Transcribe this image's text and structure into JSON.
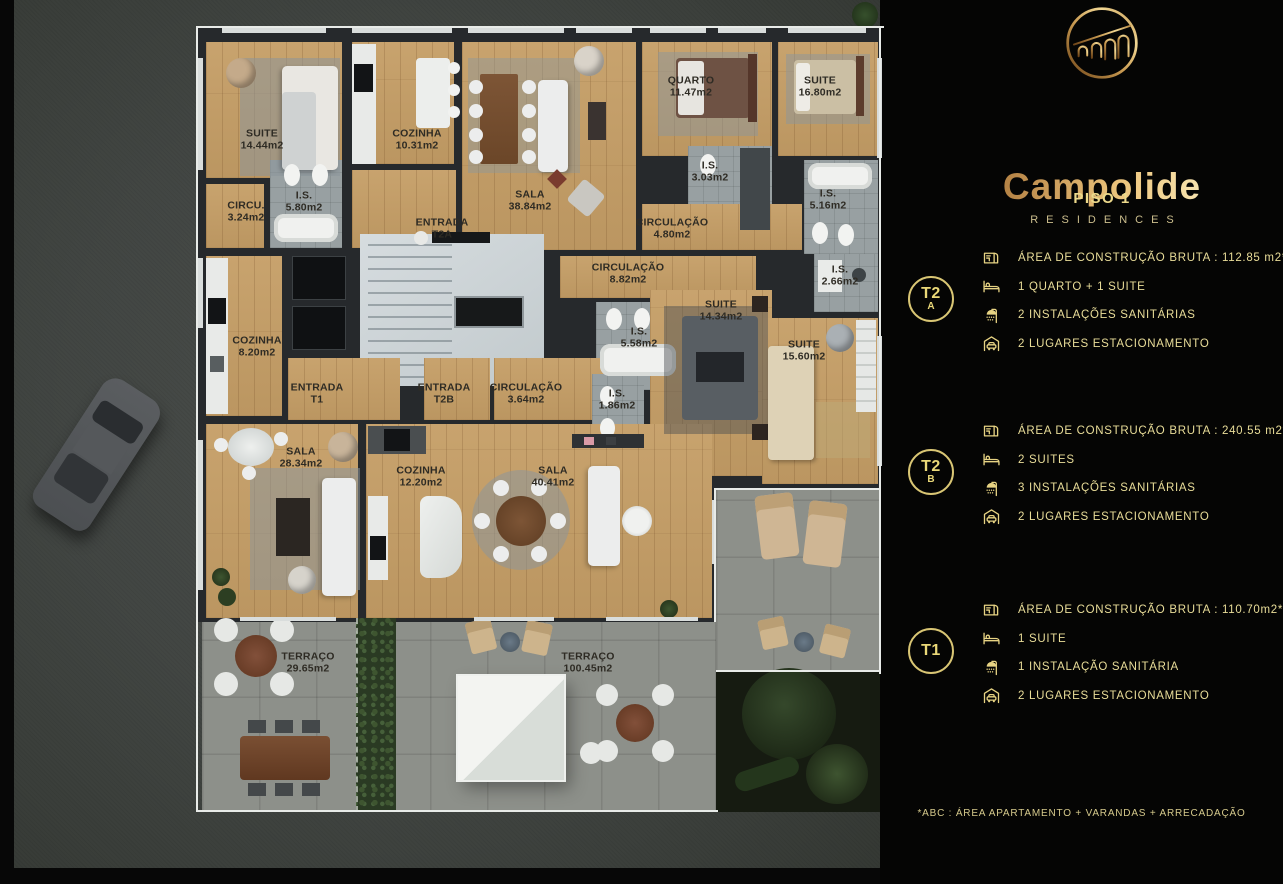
{
  "panel": {
    "brand": "Campolide",
    "brand_sub": "RESIDENCES",
    "floor_title": "PISO 1",
    "units": [
      {
        "badge": "T2",
        "badge_sub": "A",
        "specs": [
          {
            "icon": "floor-area-icon",
            "text": "ÁREA DE CONSTRUÇÃO BRUTA :  112.85 m2*"
          },
          {
            "icon": "bed-icon",
            "text": "1 QUARTO + 1 SUITE"
          },
          {
            "icon": "shower-icon",
            "text": "2 INSTALAÇÕES SANITÁRIAS"
          },
          {
            "icon": "car-garage-icon",
            "text": "2 LUGARES ESTACIONAMENTO"
          }
        ]
      },
      {
        "badge": "T2",
        "badge_sub": "B",
        "specs": [
          {
            "icon": "floor-area-icon",
            "text": "ÁREA DE CONSTRUÇÃO BRUTA :  240.55 m2*"
          },
          {
            "icon": "bed-icon",
            "text": "2 SUITES"
          },
          {
            "icon": "shower-icon",
            "text": "3 INSTALAÇÕES SANITÁRIAS"
          },
          {
            "icon": "car-garage-icon",
            "text": "2 LUGARES ESTACIONAMENTO"
          }
        ]
      },
      {
        "badge": "T1",
        "badge_sub": "",
        "specs": [
          {
            "icon": "floor-area-icon",
            "text": "ÁREA DE CONSTRUÇÃO BRUTA :  110.70m2*"
          },
          {
            "icon": "bed-icon",
            "text": "1 SUITE"
          },
          {
            "icon": "shower-icon",
            "text": "1 INSTALAÇÃO SANITÁRIA"
          },
          {
            "icon": "car-garage-icon",
            "text": "2 LUGARES ESTACIONAMENTO"
          }
        ]
      }
    ],
    "footnote": "*ABC :  ÁREA APARTAMENTO + VARANDAS + ARRECADAÇÃO"
  },
  "plan": {
    "rooms": [
      {
        "name": "SUITE",
        "area": "14.44m2"
      },
      {
        "name": "COZINHA",
        "area": "10.31m2"
      },
      {
        "name": "I.S.",
        "area": "5.80m2"
      },
      {
        "name": "CIRCU.",
        "area": "3.24m2"
      },
      {
        "name": "ENTRADA",
        "area": "T2A"
      },
      {
        "name": "SALA",
        "area": "38.84m2"
      },
      {
        "name": "QUARTO",
        "area": "11.47m2"
      },
      {
        "name": "SUITE",
        "area": "16.80m2"
      },
      {
        "name": "I.S.",
        "area": "3.03m2"
      },
      {
        "name": "I.S.",
        "area": "5.16m2"
      },
      {
        "name": "CIRCULAÇÃO",
        "area": "4.80m2"
      },
      {
        "name": "CIRCULAÇÃO",
        "area": "8.82m2"
      },
      {
        "name": "I.S.",
        "area": "5.58m2"
      },
      {
        "name": "SUITE",
        "area": "14.34m2"
      },
      {
        "name": "I.S.",
        "area": "2.66m2"
      },
      {
        "name": "SUITE",
        "area": "15.60m2"
      },
      {
        "name": "COZINHA",
        "area": "8.20m2"
      },
      {
        "name": "ENTRADA",
        "area": "T1"
      },
      {
        "name": "ENTRADA",
        "area": "T2B"
      },
      {
        "name": "CIRCULAÇÃO",
        "area": "3.64m2"
      },
      {
        "name": "I.S.",
        "area": "1.86m2"
      },
      {
        "name": "SALA",
        "area": "28.34m2"
      },
      {
        "name": "COZINHA",
        "area": "12.20m2"
      },
      {
        "name": "SALA",
        "area": "40.41m2"
      },
      {
        "name": "TERRAÇO",
        "area": "29.65m2"
      },
      {
        "name": "TERRAÇO",
        "area": "100.45m2"
      }
    ]
  },
  "colors": {
    "gold_text": "#e9dd99",
    "gold_line": "#d9c674",
    "panel_bg": "#050504",
    "wood": "#c59e66",
    "wall": "#26292c",
    "terrace": "#8d908a",
    "label": "#2e2b24"
  }
}
